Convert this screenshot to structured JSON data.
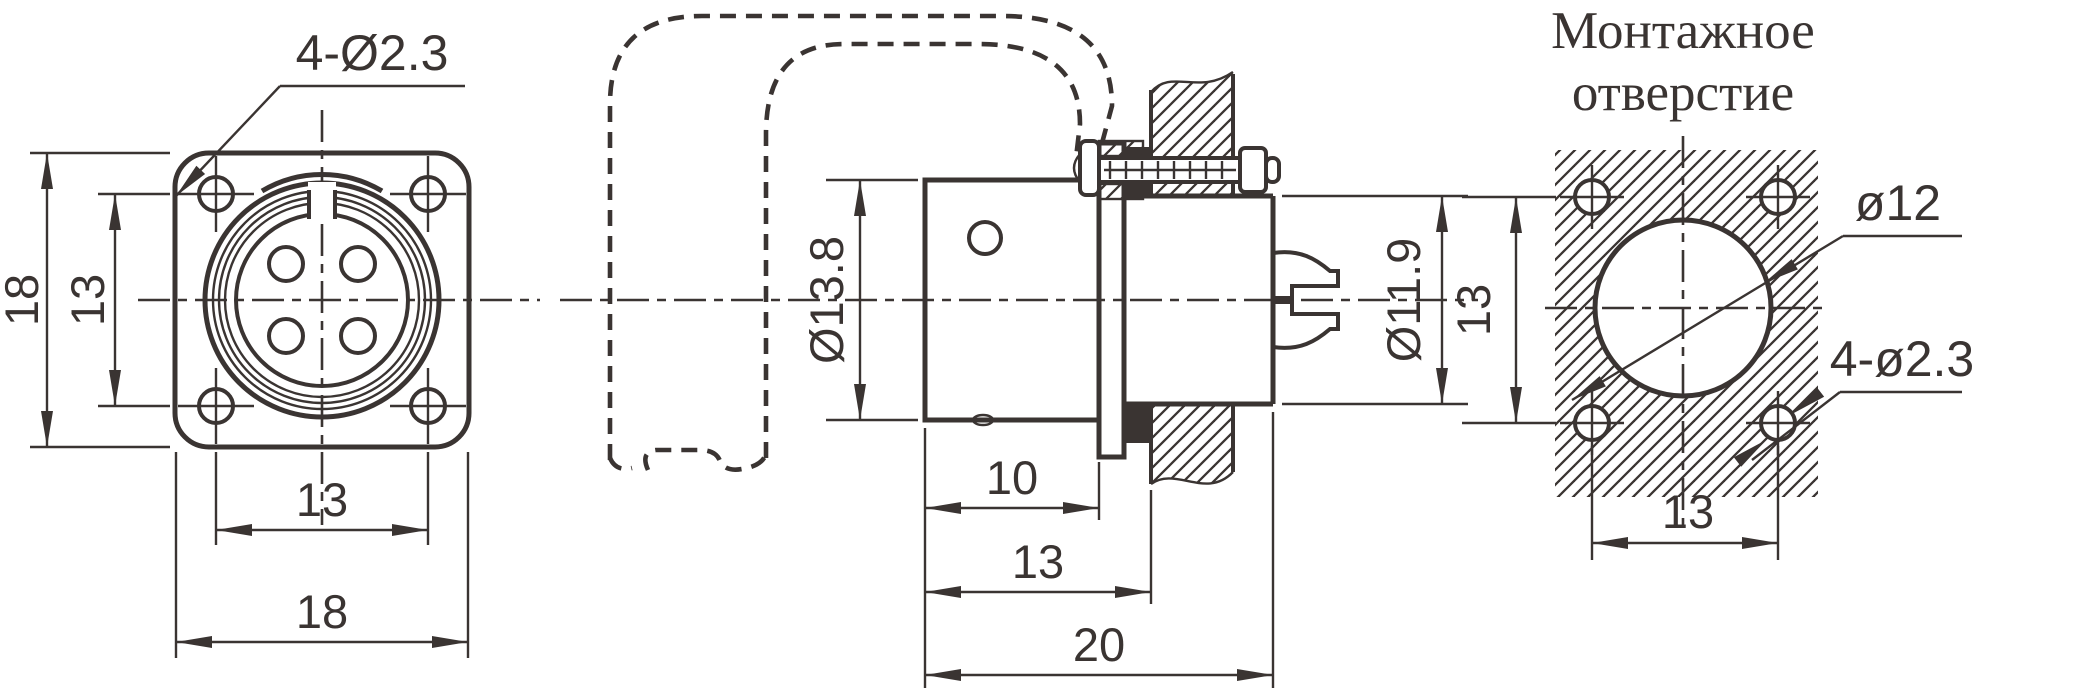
{
  "colors": {
    "line": "#3a3432",
    "background": "#ffffff"
  },
  "front_view": {
    "hole_label": "4-Ø2.3",
    "dim_height_outer": "18",
    "dim_hole_spacing_v": "13",
    "dim_hole_spacing_h": "13",
    "dim_width_outer": "18"
  },
  "side_view": {
    "dim_body_dia": "Ø13.8",
    "dim_front_dia": "Ø11.9",
    "dim_len_front": "10",
    "dim_len_to_panel": "13",
    "dim_len_total": "20"
  },
  "mounting_view": {
    "title_line1": "Монтажное",
    "title_line2": "отверстие",
    "dim_hole_spacing_v": "13",
    "dim_hole_spacing_h": "13",
    "dim_panel_hole": "ø12",
    "dim_screw_holes": "4-ø2.3"
  }
}
